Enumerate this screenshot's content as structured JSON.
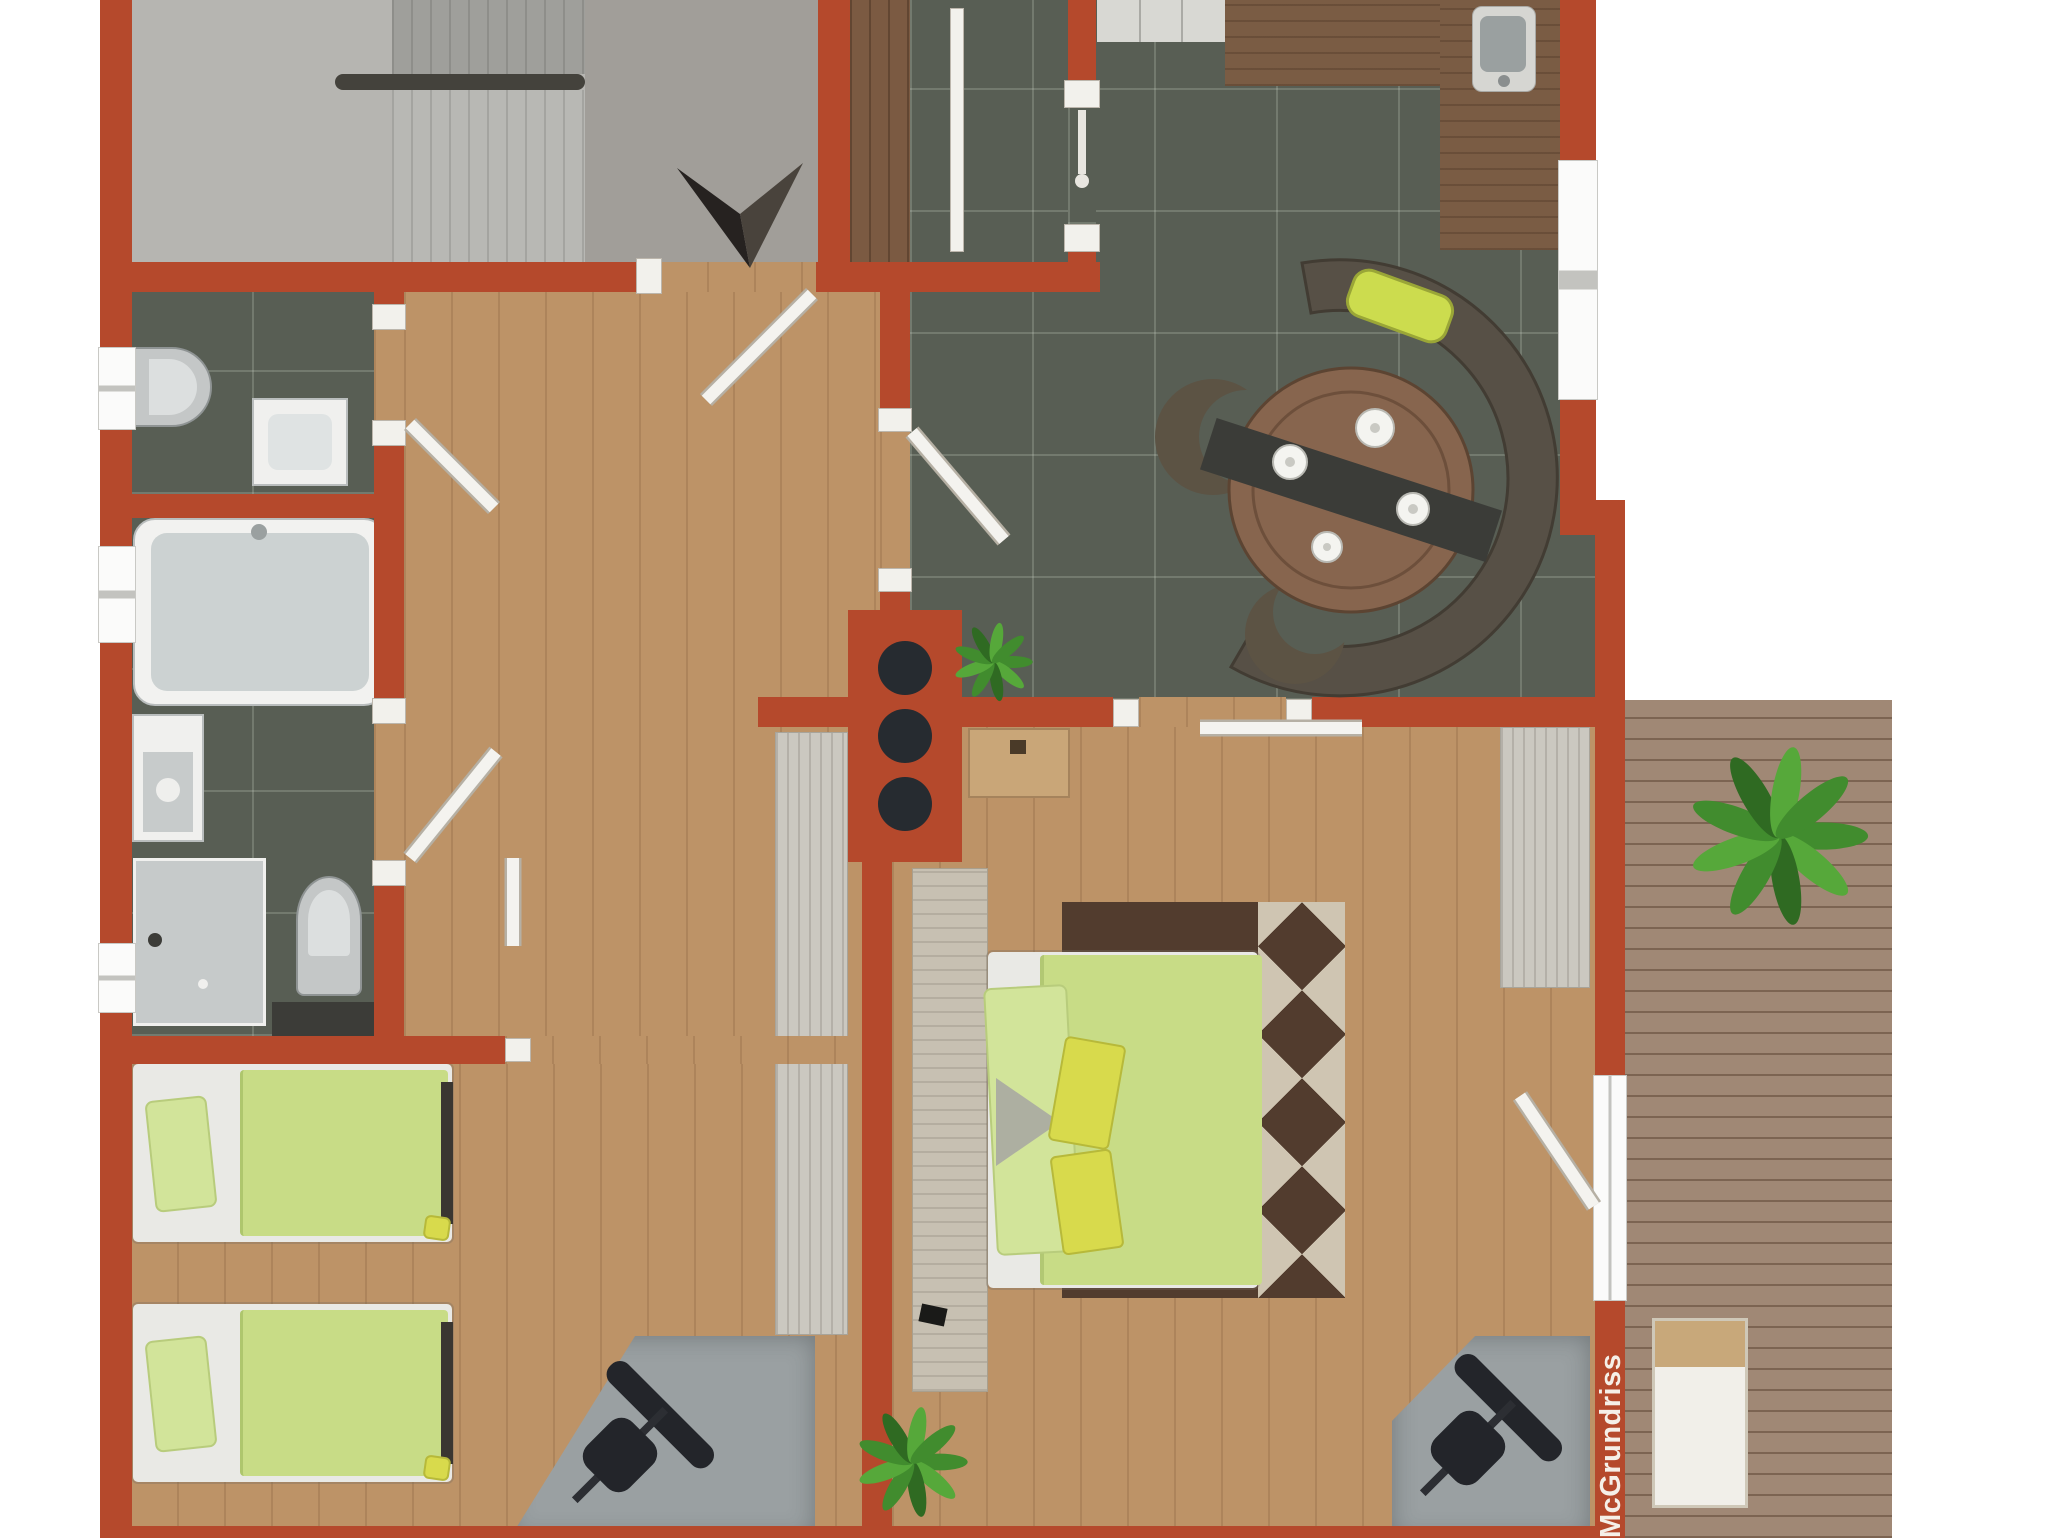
{
  "watermark": {
    "text": "McGrundriss"
  },
  "palette": {
    "wall": "#b5492c",
    "jamb": "#f2f1ec",
    "window": "#fbfbfa",
    "stairFloor": "#b6b5b1",
    "stairZone": "#a19e99",
    "stepA1": "#8e8e8a",
    "stepA2": "#9f9f9b",
    "stepB1": "#a4a4a0",
    "stepB2": "#b8b8b4",
    "handrail": "#44423c",
    "tile": "#585e54",
    "grout": "rgba(210,220,205,.22)",
    "oak": "#bd9367",
    "entryWood": "#7b5a42",
    "deck": "#a08875",
    "deckLine": "rgba(70,45,28,.40)",
    "counterWood": "#7a5c44",
    "appliance": "#d8d8d3",
    "darkCounter": "#3c3c38",
    "fixture": "#f0f0ee",
    "fixtureInner": "#ccd2d2",
    "bedFrame": "#e9e9e5",
    "duvet": "#c8dc86",
    "pillowGreen": "#d2e49a",
    "pillowYellow": "#d8da4c",
    "footboard": "#3a3631",
    "stone": "#c7c0b2",
    "rug": "#523c2e",
    "rugDiamond": "#cfc5b2",
    "wardrobe": "#cbc8c0",
    "desk": "#9aa0a2",
    "chair": "#23252a",
    "dresser": "#c9a678",
    "benchColor": "#575046",
    "tableColor": "#87654e",
    "runnerDark": "#3b3c38",
    "cushion": "#ccdc4e",
    "plantDark": "#2f6a22",
    "plantMid": "#418c2e",
    "plantLight": "#56a83a",
    "arrowDark": "#262220",
    "arrowLight": "#49433c",
    "watermarkColor": "#f5efe8"
  },
  "inventory": {
    "staircase": 1,
    "bathrooms": 2,
    "toilets": 2,
    "bathtub": 1,
    "shower": 1,
    "washing_machine": 1,
    "kitchen_sink": 1,
    "dining_set_seats_curved_bench": 1,
    "double_bed": 1,
    "single_beds": 2,
    "desks_with_office_chairs": 2,
    "wardrobes": 2,
    "plants": 3,
    "terrace_lounger": 1
  }
}
